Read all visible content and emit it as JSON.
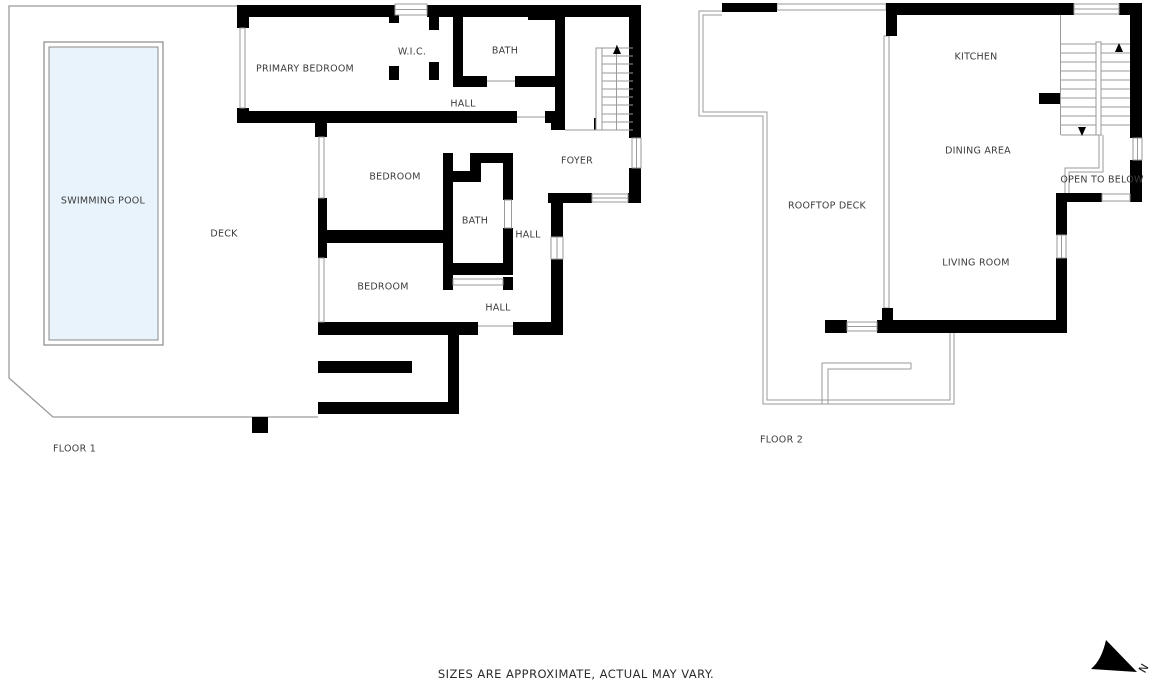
{
  "floor1": {
    "label": "FLOOR 1",
    "rooms": {
      "swimming_pool": "SWIMMING POOL",
      "deck": "DECK",
      "primary_bedroom": "PRIMARY BEDROOM",
      "wic": "W.I.C.",
      "bath_upper": "BATH",
      "hall_upper": "HALL",
      "foyer": "FOYER",
      "bedroom_middle": "BEDROOM",
      "bath_middle": "BATH",
      "hall_middle": "HALL",
      "bedroom_lower": "BEDROOM",
      "hall_lower": "HALL"
    }
  },
  "floor2": {
    "label": "FLOOR 2",
    "rooms": {
      "kitchen": "KITCHEN",
      "dining_area": "DINING AREA",
      "rooftop_deck": "ROOFTOP DECK",
      "living_room": "LIVING ROOM",
      "open_to_below": "OPEN TO BELOW"
    }
  },
  "compass": {
    "north_label": "N"
  },
  "footer": {
    "disclaimer": "SIZES ARE APPROXIMATE, ACTUAL MAY VARY."
  },
  "colors": {
    "wall": "#000000",
    "thin_line": "#9a9a9a",
    "pool_fill": "#e8f3fb",
    "pool_border": "#8a8a8a",
    "text": "#3b3b3b",
    "background": "#ffffff"
  }
}
